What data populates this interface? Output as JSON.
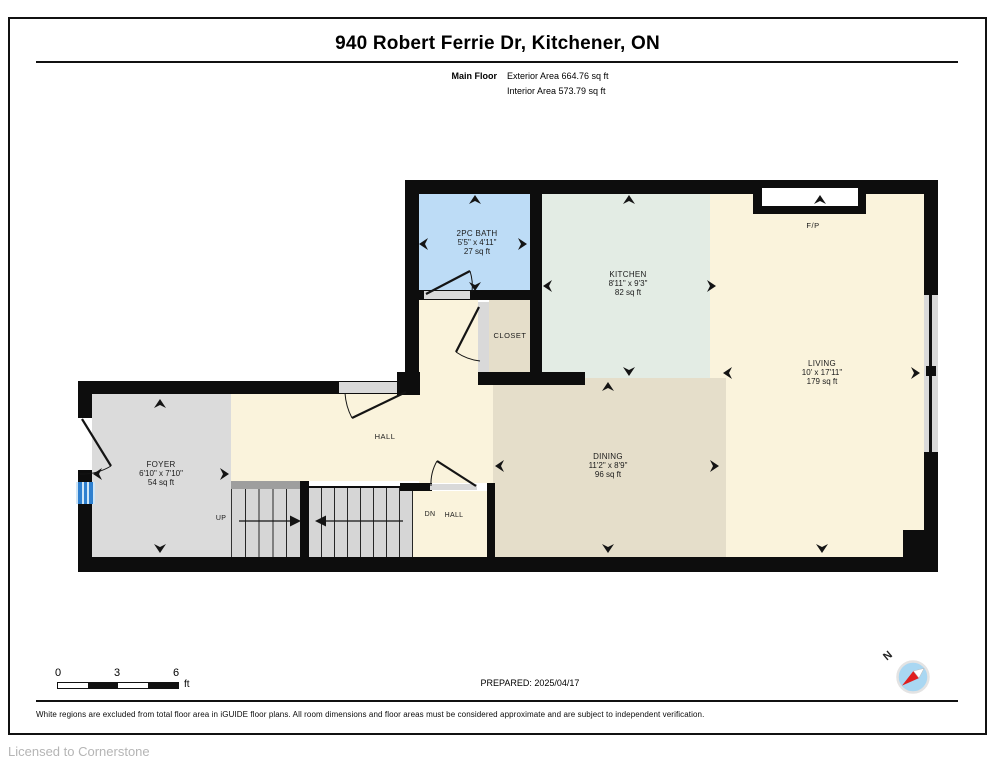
{
  "header": {
    "title": "940 Robert Ferrie Dr, Kitchener, ON",
    "floor_label": "Main Floor",
    "exterior_area": "Exterior Area 664.76 sq ft",
    "interior_area": "Interior Area 573.79 sq ft"
  },
  "rooms": {
    "bath": {
      "name": "2PC BATH",
      "dims": "5'5\" x 4'11\"",
      "area": "27 sq ft"
    },
    "kitchen": {
      "name": "KITCHEN",
      "dims": "8'11\" x 9'3\"",
      "area": "82 sq ft"
    },
    "living": {
      "name": "LIVING",
      "dims": "10' x 17'11\"",
      "area": "179 sq ft"
    },
    "dining": {
      "name": "DINING",
      "dims": "11'2\" x 8'9\"",
      "area": "96 sq ft"
    },
    "foyer": {
      "name": "FOYER",
      "dims": "6'10\" x 7'10\"",
      "area": "54 sq ft"
    },
    "closet": {
      "name": "CLOSET"
    },
    "hall": {
      "name": "HALL"
    },
    "dn_hall": {
      "dn": "DN",
      "hall": "HALL"
    },
    "fireplace": {
      "name": "F/P"
    },
    "stairs": {
      "up_label": "UP"
    }
  },
  "scale_bar": {
    "tick_0": "0",
    "tick_3": "3",
    "tick_6": "6",
    "unit": "ft"
  },
  "footer": {
    "prepared": "PREPARED: 2025/04/17",
    "disclaimer": "White regions are excluded from total floor area in iGUIDE floor plans. All room dimensions and floor areas must be considered approximate and are subject to independent verification.",
    "licensed": "Licensed to Cornerstone"
  },
  "compass": {
    "north_label": "N"
  },
  "colors": {
    "bath": "#bddcf6",
    "kitchen": "#e3ece4",
    "living": "#faf3dc",
    "dining": "#e5deca",
    "foyer": "#dbdbdb",
    "stairs": "#d6d6d6",
    "wall": "#0d0d0d",
    "window_blue": "#2f80cf",
    "compass_blue": "#a9d7f2",
    "compass_red": "#e01f1f"
  }
}
